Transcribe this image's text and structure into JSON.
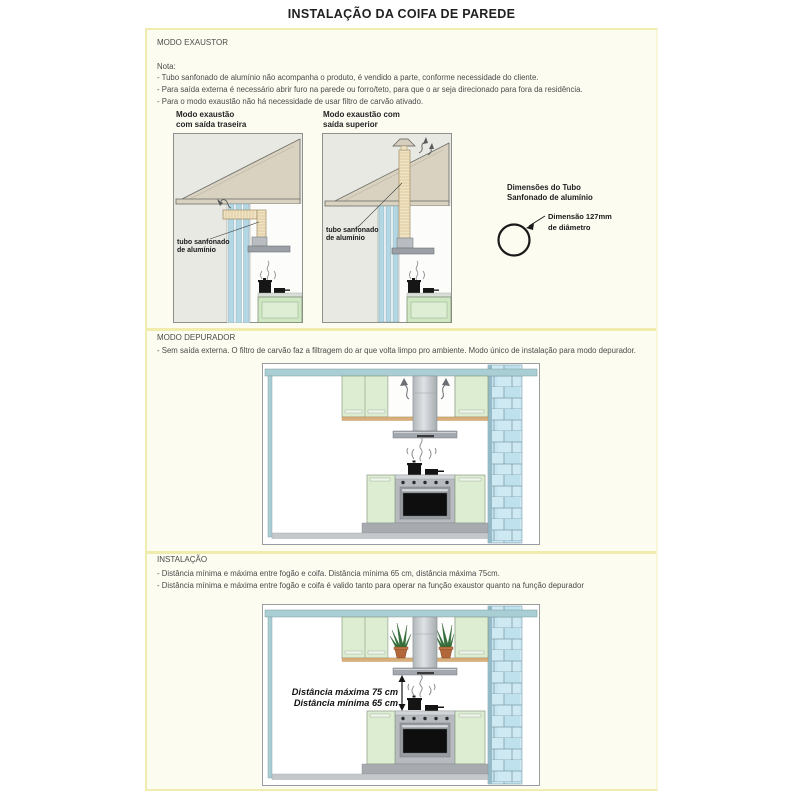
{
  "page": {
    "title": "INSTALAÇÃO DA COIFA DE PAREDE"
  },
  "exaustor": {
    "header": "MODO EXAUSTOR",
    "nota_label": "Nota:",
    "notes": [
      "- Tubo sanfonado de alumínio não acompanha o produto, é vendido a parte, conforme necessidade do cliente.",
      "- Para saída externa é necessário abrir furo na parede ou forro/teto, para que o ar seja direcionado para fora da residência.",
      "- Para o modo exaustão não há necessidade de usar filtro de carvão ativado."
    ],
    "rear": {
      "title1": "Modo exaustão",
      "title2": "com saída traseira",
      "label1": "tubo sanfonado",
      "label2": "de alumínio"
    },
    "superior": {
      "title1": "Modo exaustão com",
      "title2": "saída superior",
      "label1": "tubo sanfonado",
      "label2": "de alumínio"
    },
    "dims": {
      "heading1": "Dimensões do Tubo",
      "heading2": "Sanfonado de alumínio",
      "value1": "Dimensão 127mm",
      "value2": "de diâmetro"
    }
  },
  "depurador": {
    "header": "MODO DEPURADOR",
    "note": "- Sem saída externa. O filtro de carvão faz a filtragem do ar que volta limpo pro ambiente. Modo único de instalação para modo depurador."
  },
  "instalacao": {
    "header": "INSTALAÇÃO",
    "notes": [
      "- Distância mínima e máxima entre fogão e coifa. Distância mínima 65 cm, distância máxima 75cm.",
      "- Distância mínima e máxima entre fogão e coifa é valido tanto para operar na função exaustor quanto na função depurador"
    ],
    "distance_max": "Distância máxima 75 cm",
    "distance_min": "Distância mínima 65 cm"
  },
  "colors": {
    "divider_yellow": "#f0ecae",
    "panel_cream": "#fdfcf1",
    "cabinet_green": "#dcedd2",
    "brick_blue": "#cfe9f2",
    "wall_teal": "#a9ced4",
    "roof_beige": "#d9d2c1"
  }
}
